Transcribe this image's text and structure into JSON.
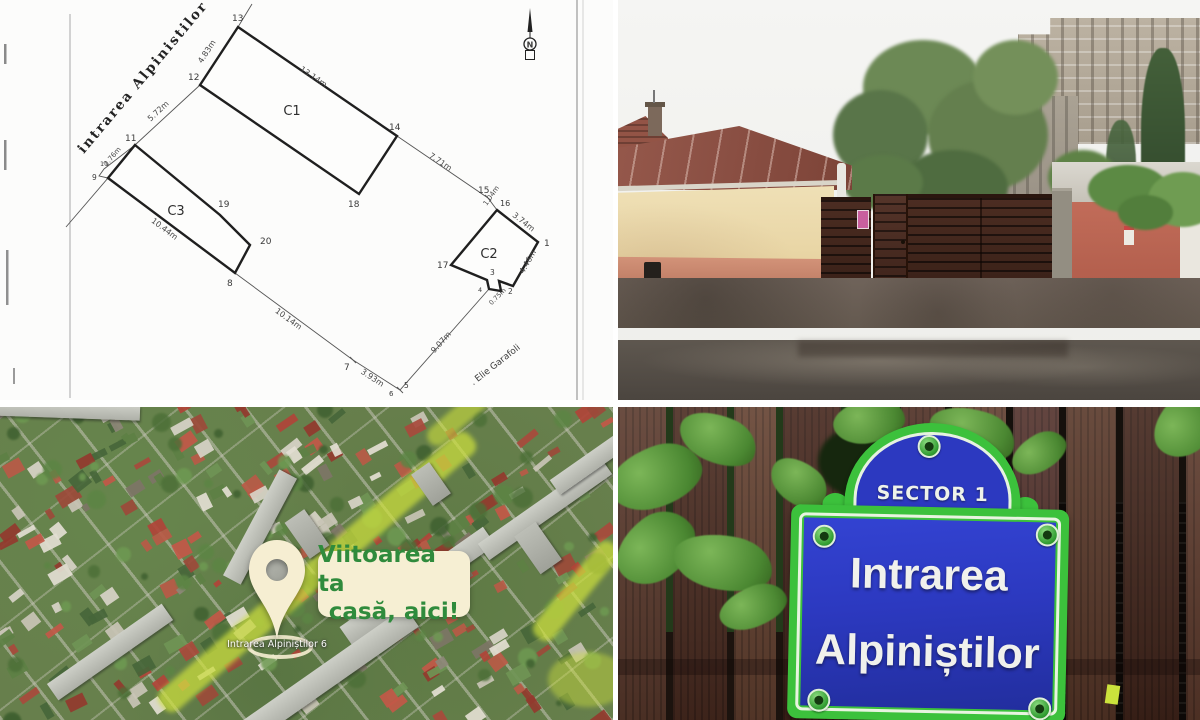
{
  "plan": {
    "street": "intrarea  Alpinistilor",
    "side_street": ". Elie Garafoli",
    "north": "N",
    "c1": "C1",
    "c2": "C2",
    "c3": "C3",
    "points": {
      "p1": "1",
      "p2": "2",
      "p3": "3",
      "p4": "4",
      "p5": "5",
      "p6": "6",
      "p7": "7",
      "p8": "8",
      "p9": "9",
      "p10": "10",
      "p11": "11",
      "p12": "12",
      "p13": "13",
      "p14": "14",
      "p15": "15",
      "p16": "16",
      "p17": "17",
      "p18": "18",
      "p19": "19",
      "p20": "20"
    },
    "dims": {
      "d12_13": "4.83m",
      "d11_12": "5.72m",
      "d10_11": "2.76m",
      "d13_14": "13.14m",
      "d14_15": "7.71m",
      "d15_16": "1.04m",
      "d16_1": "3.74m",
      "d1_2": "4.46m",
      "d2_3": "0.75m",
      "d9_8": "10.44m",
      "d8_7": "10.14m",
      "d7_6": "3.93m",
      "d5_4": "9.07m"
    }
  },
  "map": {
    "ribbon_line1": "Viitoarea ta",
    "ribbon_line2": "casă, aici!",
    "pin_label": "Intrarea Alpiniștilor 6"
  },
  "sign": {
    "sector": "SECTOR 1",
    "line1": "Intrarea",
    "line2": "Alpiniștilor"
  },
  "colors": {
    "sign_green": "#3cc13c",
    "sign_blue": "#2c39c0",
    "ribbon_bg": "#f6efd3",
    "ribbon_text": "#2f8b3c",
    "pin_cream": "#f6eed2"
  }
}
